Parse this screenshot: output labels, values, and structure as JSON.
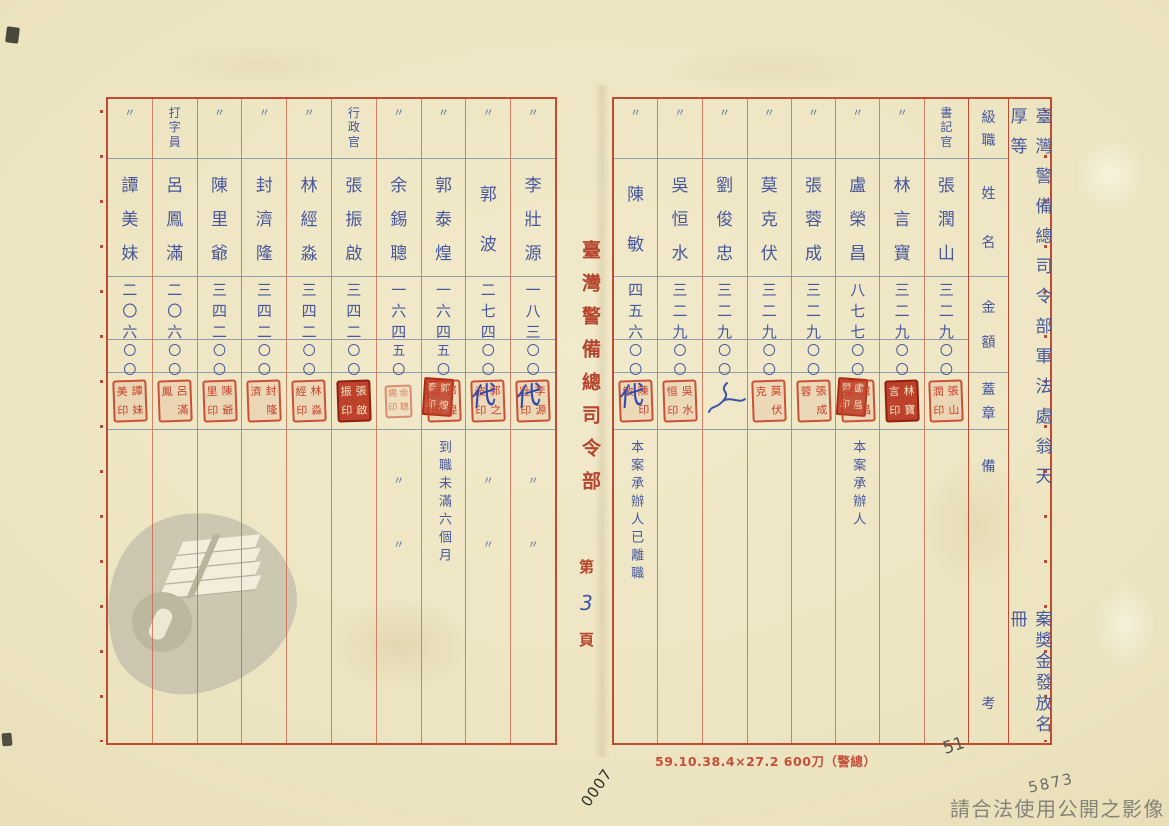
{
  "document": {
    "title": "臺灣警備總司令部軍法處翁天厚等",
    "title_second": "案獎金發放名冊",
    "spine_org": "臺灣警備總司令部",
    "page_prefix": "第",
    "page_number": "3",
    "page_suffix": "頁",
    "print_note": "59.10.38.4×27.2 600刀（警總）",
    "serial_handwritten": "0007",
    "pencil_top": "51",
    "pencil_bottom": "5873",
    "usage_watermark": "請合法使用公開之影像"
  },
  "columns_header": {
    "rank": "級職",
    "name": "姓名",
    "amount": "金額",
    "seal": "蓋章",
    "remark": "備考"
  },
  "right_page": {
    "entries": [
      {
        "rank": "書記官",
        "name": "張潤山",
        "amount": "三二九",
        "amount_tail": "〇〇",
        "seal": "張潤山印",
        "seal_style": "outline",
        "seal_note": "",
        "remark": "",
        "remark_style": "none"
      },
      {
        "rank": "〃",
        "name": "林言寶",
        "amount": "三二九",
        "amount_tail": "〇〇",
        "seal": "林言寶印",
        "seal_style": "solid",
        "seal_note": "",
        "remark": "",
        "remark_style": "none"
      },
      {
        "rank": "〃",
        "name": "盧榮昌",
        "amount": "八七七",
        "amount_tail": "〇〇",
        "seal": "盧榮昌印",
        "seal_style": "double",
        "seal_note": "",
        "remark": "本案承辦人",
        "remark_style": "text"
      },
      {
        "rank": "〃",
        "name": "張蓉成",
        "amount": "三二九",
        "amount_tail": "〇〇",
        "seal": "張蓉成",
        "seal_style": "outline",
        "seal_note": "",
        "remark": "",
        "remark_style": "none"
      },
      {
        "rank": "〃",
        "name": "莫克伏",
        "amount": "三二九",
        "amount_tail": "〇〇",
        "seal": "莫克伏",
        "seal_style": "outline",
        "seal_note": "",
        "remark": "",
        "remark_style": "none"
      },
      {
        "rank": "〃",
        "name": "劉俊忠",
        "amount": "三二九",
        "amount_tail": "〇〇",
        "seal": "",
        "seal_style": "signature",
        "seal_note": "",
        "remark": "",
        "remark_style": "none"
      },
      {
        "rank": "〃",
        "name": "吳恒水",
        "amount": "三二九",
        "amount_tail": "〇〇",
        "seal": "吳恒水印",
        "seal_style": "outline",
        "seal_note": "",
        "remark": "",
        "remark_style": "none"
      },
      {
        "rank": "〃",
        "name": "陳敏",
        "amount": "四五六",
        "amount_tail": "〇〇",
        "seal": "陳敏印",
        "seal_style": "outline",
        "seal_note": "代",
        "remark": "本案承辦人已離職",
        "remark_style": "text"
      }
    ]
  },
  "left_page": {
    "entries": [
      {
        "rank": "〃",
        "name": "李壯源",
        "amount": "一八三",
        "amount_tail": "〇〇",
        "seal": "李壯源印",
        "seal_style": "outline",
        "seal_note": "代",
        "remark": "〃〃",
        "remark_style": "ditto"
      },
      {
        "rank": "〃",
        "name": "郭波",
        "amount": "二七四",
        "amount_tail": "〇〇",
        "seal": "郭波之印",
        "seal_style": "outline",
        "seal_note": "代",
        "remark": "〃〃",
        "remark_style": "ditto"
      },
      {
        "rank": "〃",
        "name": "郭泰煌",
        "amount": "一六四",
        "amount_tail": "五〇",
        "seal": "郭泰煌印",
        "seal_style": "double",
        "seal_note": "",
        "remark": "到職未滿六個月",
        "remark_style": "text"
      },
      {
        "rank": "〃",
        "name": "余錫聰",
        "amount": "一六四",
        "amount_tail": "五〇",
        "seal": "余錫聰印",
        "seal_style": "small",
        "seal_note": "",
        "remark": "〃〃",
        "remark_style": "ditto"
      },
      {
        "rank": "行政官",
        "name": "張振啟",
        "amount": "三四二",
        "amount_tail": "〇〇",
        "seal": "張振啟印",
        "seal_style": "solid",
        "seal_note": "",
        "remark": "",
        "remark_style": "none"
      },
      {
        "rank": "〃",
        "name": "林經淼",
        "amount": "三四二",
        "amount_tail": "〇〇",
        "seal": "林經淼印",
        "seal_style": "outline",
        "seal_note": "",
        "remark": "",
        "remark_style": "none"
      },
      {
        "rank": "〃",
        "name": "封濟隆",
        "amount": "三四二",
        "amount_tail": "〇〇",
        "seal": "封濟隆",
        "seal_style": "outline",
        "seal_note": "",
        "remark": "",
        "remark_style": "none"
      },
      {
        "rank": "〃",
        "name": "陳里爺",
        "amount": "三四二",
        "amount_tail": "〇〇",
        "seal": "陳里爺印",
        "seal_style": "outline",
        "seal_note": "",
        "remark": "",
        "remark_style": "none"
      },
      {
        "rank": "打字員",
        "name": "呂鳳滿",
        "amount": "二〇六",
        "amount_tail": "〇〇",
        "seal": "呂鳳滿",
        "seal_style": "outline",
        "seal_note": "",
        "remark": "",
        "remark_style": "none"
      },
      {
        "rank": "〃",
        "name": "譚美妹",
        "amount": "二〇六",
        "amount_tail": "〇〇",
        "seal": "譚美妹印",
        "seal_style": "outline",
        "seal_note": "",
        "remark": "",
        "remark_style": "none"
      }
    ]
  },
  "colors": {
    "grid_red": "#c14b31",
    "ink_blue": "#47589c",
    "seal_red": "#c8412a",
    "print_red": "#b5452e",
    "pencil_gray": "#6d6d65",
    "paper": "#ece3bf"
  }
}
